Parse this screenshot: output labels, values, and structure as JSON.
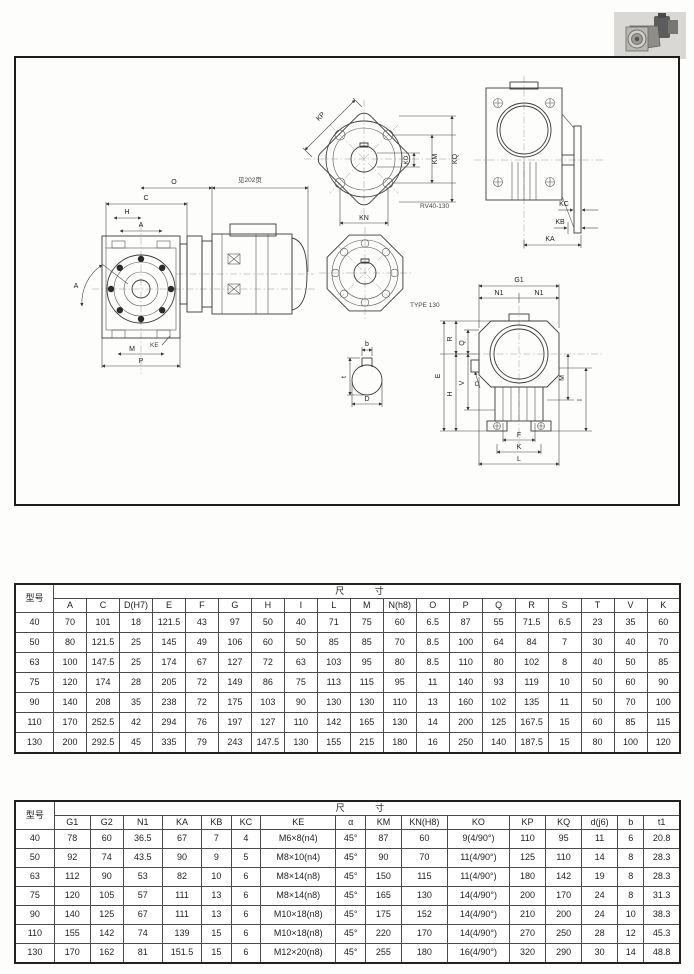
{
  "drawing": {
    "notes": {
      "see_page": "见202页",
      "flange_model": "RV40-130",
      "type": "TYPE 130"
    },
    "left": {
      "o": "O",
      "c": "C",
      "h": "H",
      "a": "A",
      "angle": "A",
      "ke": "KE",
      "m": "M",
      "p": "P"
    },
    "inflange": {
      "kp": "KP",
      "km": "KM",
      "kq": "KQ",
      "ko": "KO",
      "kn": "KN"
    },
    "key": {
      "b": "b",
      "t": "t",
      "d": "D"
    },
    "side": {
      "kc": "KC",
      "kb": "KB",
      "ka": "KA"
    },
    "rear": {
      "g1": "G1",
      "n1l": "N1",
      "n1r": "N1",
      "e": "E",
      "r": "R",
      "q": "Q",
      "h": "H",
      "v": "V",
      "o": "O",
      "i": "I",
      "m": "M",
      "f": "F",
      "k": "K",
      "l": "L"
    }
  },
  "table1": {
    "corner_header": "型号",
    "group_header": "尺  寸",
    "columns": [
      "A",
      "C",
      "D(H7)",
      "E",
      "F",
      "G",
      "H",
      "I",
      "L",
      "M",
      "N(h8)",
      "O",
      "P",
      "Q",
      "R",
      "S",
      "T",
      "V",
      "K"
    ],
    "rows": [
      {
        "model": "40",
        "values": [
          "70",
          "101",
          "18",
          "121.5",
          "43",
          "97",
          "50",
          "40",
          "71",
          "75",
          "60",
          "6.5",
          "87",
          "55",
          "71.5",
          "6.5",
          "23",
          "35",
          "60"
        ]
      },
      {
        "model": "50",
        "values": [
          "80",
          "121.5",
          "25",
          "145",
          "49",
          "106",
          "60",
          "50",
          "85",
          "85",
          "70",
          "8.5",
          "100",
          "64",
          "84",
          "7",
          "30",
          "40",
          "70"
        ]
      },
      {
        "model": "63",
        "values": [
          "100",
          "147.5",
          "25",
          "174",
          "67",
          "127",
          "72",
          "63",
          "103",
          "95",
          "80",
          "8.5",
          "110",
          "80",
          "102",
          "8",
          "40",
          "50",
          "85"
        ]
      },
      {
        "model": "75",
        "values": [
          "120",
          "174",
          "28",
          "205",
          "72",
          "149",
          "86",
          "75",
          "113",
          "115",
          "95",
          "11",
          "140",
          "93",
          "119",
          "10",
          "50",
          "60",
          "90"
        ]
      },
      {
        "model": "90",
        "values": [
          "140",
          "208",
          "35",
          "238",
          "72",
          "175",
          "103",
          "90",
          "130",
          "130",
          "110",
          "13",
          "160",
          "102",
          "135",
          "11",
          "50",
          "70",
          "100"
        ]
      },
      {
        "model": "110",
        "values": [
          "170",
          "252.5",
          "42",
          "294",
          "76",
          "197",
          "127",
          "110",
          "142",
          "165",
          "130",
          "14",
          "200",
          "125",
          "167.5",
          "15",
          "60",
          "85",
          "115"
        ]
      },
      {
        "model": "130",
        "values": [
          "200",
          "292.5",
          "45",
          "335",
          "79",
          "243",
          "147.5",
          "130",
          "155",
          "215",
          "180",
          "16",
          "250",
          "140",
          "187.5",
          "15",
          "80",
          "100",
          "120"
        ]
      }
    ]
  },
  "table2": {
    "corner_header": "型号",
    "group_header": "尺  寸",
    "columns": [
      "G1",
      "G2",
      "N1",
      "KA",
      "KB",
      "KC",
      "KE",
      "α",
      "KM",
      "KN(H8)",
      "KO",
      "KP",
      "KQ",
      "d(j6)",
      "b",
      "t1"
    ],
    "rows": [
      {
        "model": "40",
        "values": [
          "78",
          "60",
          "36.5",
          "67",
          "7",
          "4",
          "M6×8(n4)",
          "45°",
          "87",
          "60",
          "9(4/90°)",
          "110",
          "95",
          "11",
          "6",
          "20.8"
        ]
      },
      {
        "model": "50",
        "values": [
          "92",
          "74",
          "43.5",
          "90",
          "9",
          "5",
          "M8×10(n4)",
          "45°",
          "90",
          "70",
          "11(4/90°)",
          "125",
          "110",
          "14",
          "8",
          "28.3"
        ]
      },
      {
        "model": "63",
        "values": [
          "112",
          "90",
          "53",
          "82",
          "10",
          "6",
          "M8×14(n8)",
          "45°",
          "150",
          "115",
          "11(4/90°)",
          "180",
          "142",
          "19",
          "8",
          "28.3"
        ]
      },
      {
        "model": "75",
        "values": [
          "120",
          "105",
          "57",
          "111",
          "13",
          "6",
          "M8×14(n8)",
          "45°",
          "165",
          "130",
          "14(4/90°)",
          "200",
          "170",
          "24",
          "8",
          "31.3"
        ]
      },
      {
        "model": "90",
        "values": [
          "140",
          "125",
          "67",
          "111",
          "13",
          "6",
          "M10×18(n8)",
          "45°",
          "175",
          "152",
          "14(4/90°)",
          "210",
          "200",
          "24",
          "10",
          "38.3"
        ]
      },
      {
        "model": "110",
        "values": [
          "155",
          "142",
          "74",
          "139",
          "15",
          "6",
          "M10×18(n8)",
          "45°",
          "220",
          "170",
          "14(4/90°)",
          "270",
          "250",
          "28",
          "12",
          "45.3"
        ]
      },
      {
        "model": "130",
        "values": [
          "170",
          "162",
          "81",
          "151.5",
          "15",
          "6",
          "M12×20(n8)",
          "45°",
          "255",
          "180",
          "16(4/90°)",
          "320",
          "290",
          "30",
          "14",
          "48.8"
        ]
      }
    ]
  }
}
